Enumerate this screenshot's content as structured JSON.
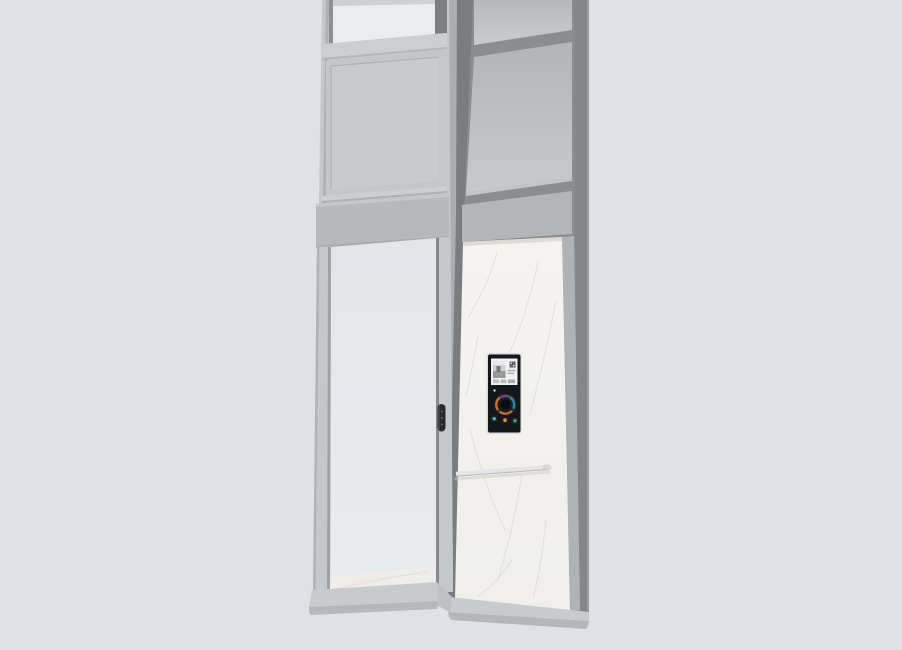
{
  "scene": {
    "subject": "home-lift-product-render"
  },
  "colors": {
    "background": "#dee1e6",
    "front_face": "#c5c8ca",
    "front_panel": "#c4c7c9",
    "front_panel_inner": "#c8cbcd",
    "rail_light": "#cccfd1",
    "header_band": "#b6b9bb",
    "side_band": "#b3b6b8",
    "glass_top": "#e9edf0",
    "glass_door": "#e4e8ea",
    "frame_dark": "#8b8e91",
    "corner_dark": "#7a7d80",
    "corner_light": "#abaeb0",
    "right_column": "#84878a",
    "column_highlight": "#989b9e",
    "side_trim": "#b0b3b5",
    "marble": "#f3f2ee",
    "marble_vein": "#d7d4cc",
    "marble_shadow": "#dedbd5",
    "floor": "#efeeea",
    "sill": "#c8cbcd",
    "sill_lip": "#b4b7b9",
    "sill_shadow": "#a2a5a7",
    "jamb_recess": "#9fa2a4",
    "stile_line": "#87898c",
    "handrail": "#e3e5e6",
    "handrail_under": "#aeb1b3",
    "handrail_cap": "#d6d8d9",
    "handrail_shadow": "#cfccc5",
    "handle_body": "#27282a",
    "handle_dot": "#606264",
    "window_stile_dark": "#7c7f82",
    "window_jamb_dark": "#8e9194",
    "window_top_bar": "#ced1d4"
  },
  "cop": {
    "bezel": "#d9dbdc",
    "body": "#151619",
    "screen_bg": "#f0f1f2",
    "screen": {
      "photo_top": "#e9e9e7",
      "photo_mid": "#cfcfcd",
      "photo_dark": "#97999a",
      "photo_detail": "#767876",
      "qr_block": "#5f615f",
      "text_line": "#a9abac",
      "thumb_1": "#c0c2c1",
      "thumb_2": "#b7b9b8",
      "thumb_3": "#acadae"
    },
    "indicator_dot": "#d2d4d5",
    "dial": {
      "face": "#0c0d0f",
      "ring_base": "#2a2c2f",
      "ring_orange": "#c9733a",
      "ring_teal": "#2e8fa0",
      "ring_purple": "#7c4f9e"
    },
    "buttons": [
      {
        "name": "call-button-teal",
        "color": "#2fc9c4"
      },
      {
        "name": "call-button-amber",
        "color": "#d9923c"
      },
      {
        "name": "call-button-green",
        "color": "#3fae62"
      }
    ]
  }
}
